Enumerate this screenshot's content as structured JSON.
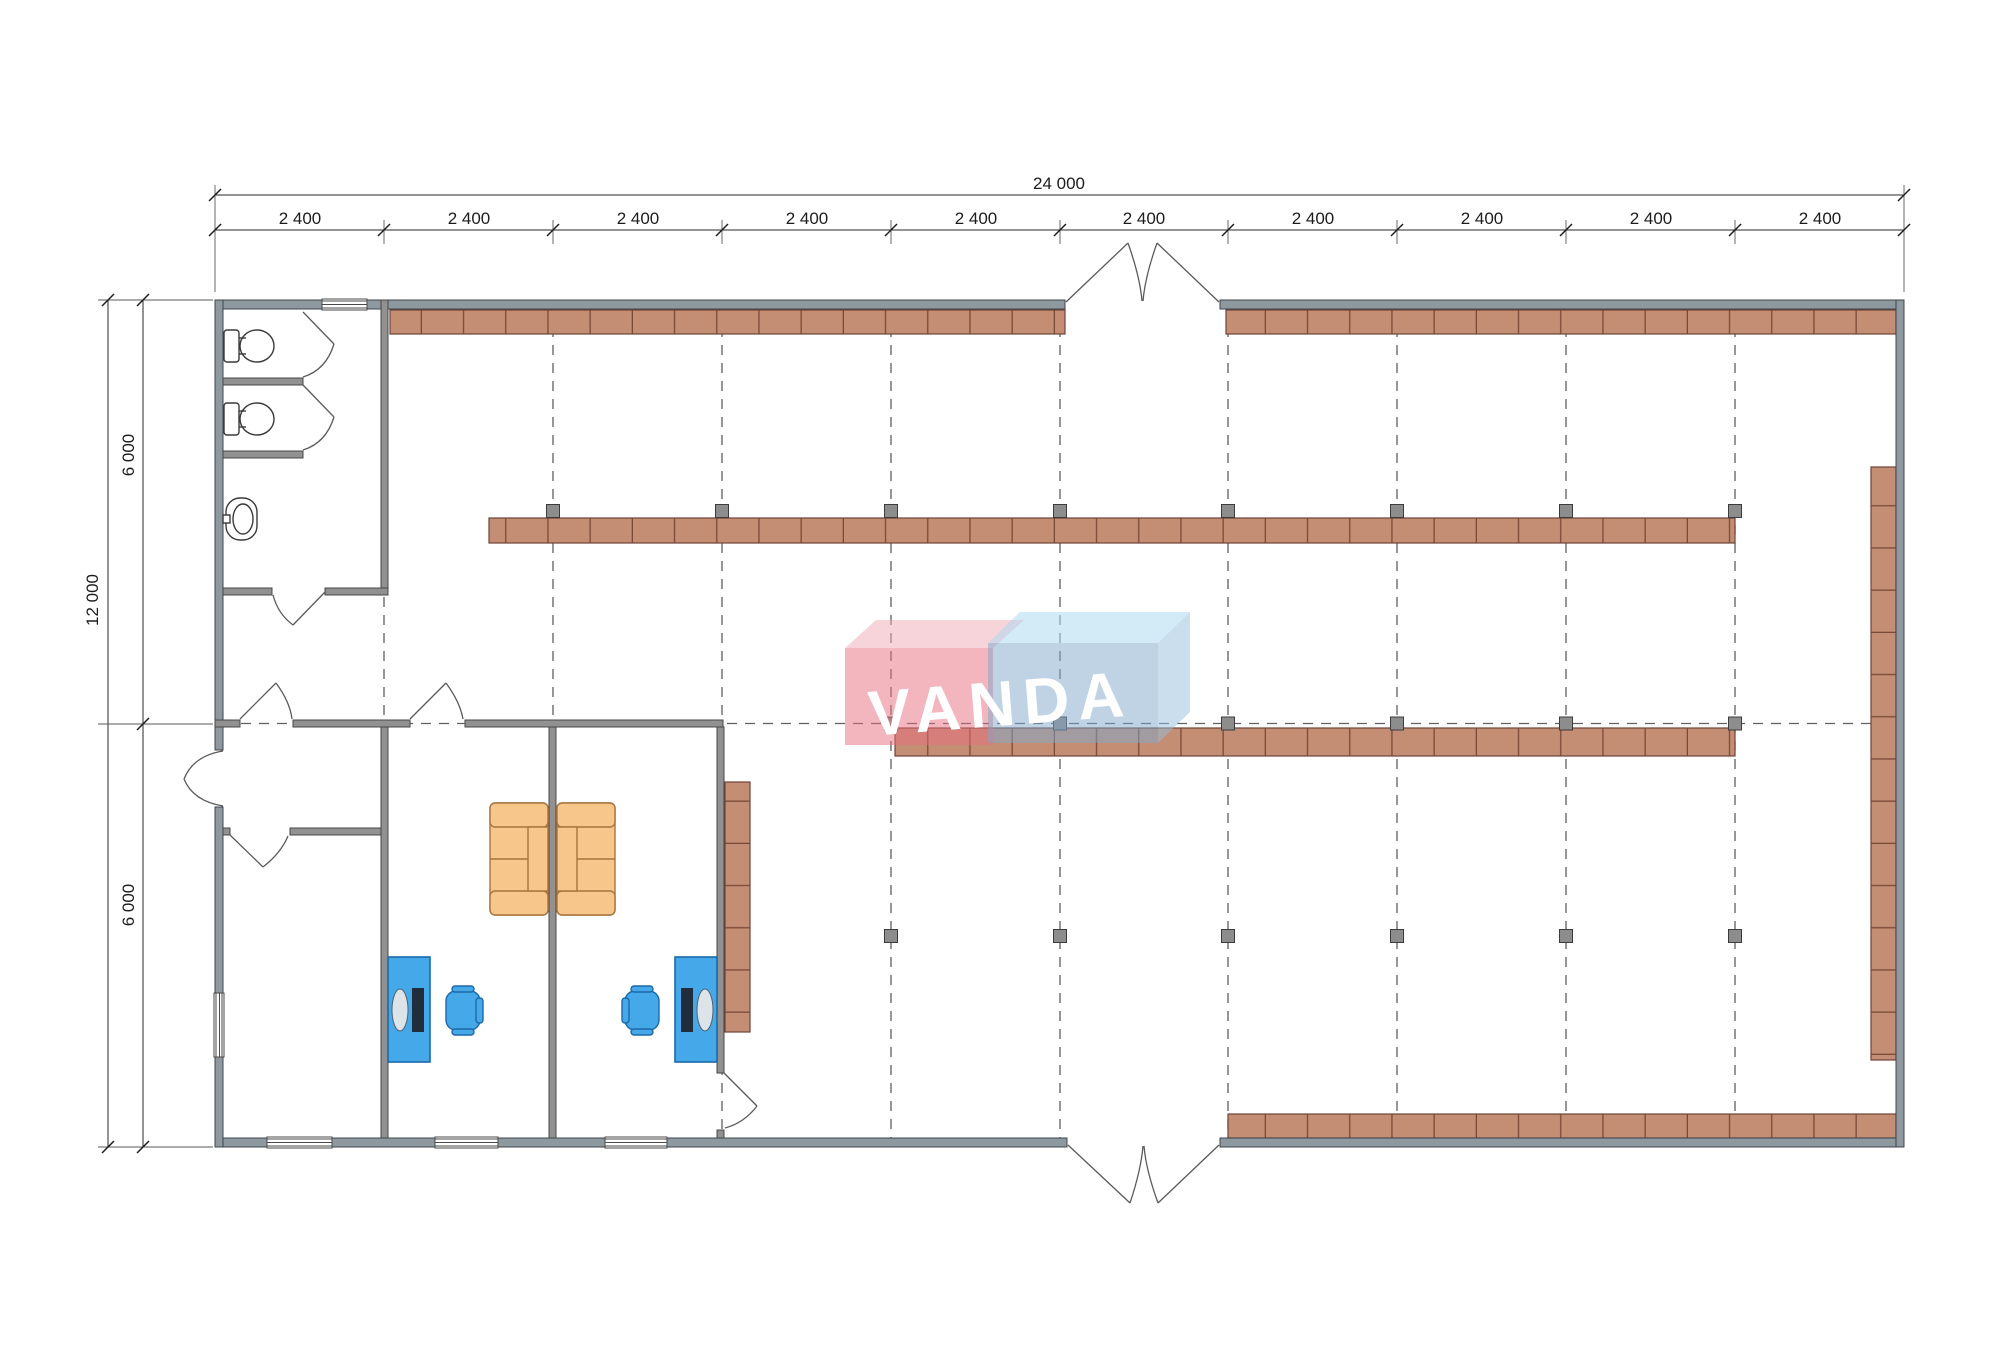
{
  "title": "floor-plan-drawing",
  "dims": {
    "top_total": "24 000",
    "top_segments": [
      "2 400",
      "2 400",
      "2 400",
      "2 400",
      "2 400",
      "2 400",
      "2 400",
      "2 400",
      "2 400",
      "2 400"
    ],
    "left_total": "12 000",
    "left_segments": [
      "6 000",
      "6 000"
    ]
  },
  "logo": {
    "text": "VANDA",
    "red": "#e86e80",
    "blue": "#80a8cc"
  },
  "colors": {
    "shelf": "#c48e74",
    "shelf_line": "#6e4437",
    "wall_exterior": "#8e989f",
    "wall_interior": "#919191",
    "desk": "#45a9e9",
    "chair": "#45a9e9",
    "sofa": "#f7c68b",
    "column_marker": "#8d8d8d",
    "grid_line": "#5f5f5f"
  }
}
